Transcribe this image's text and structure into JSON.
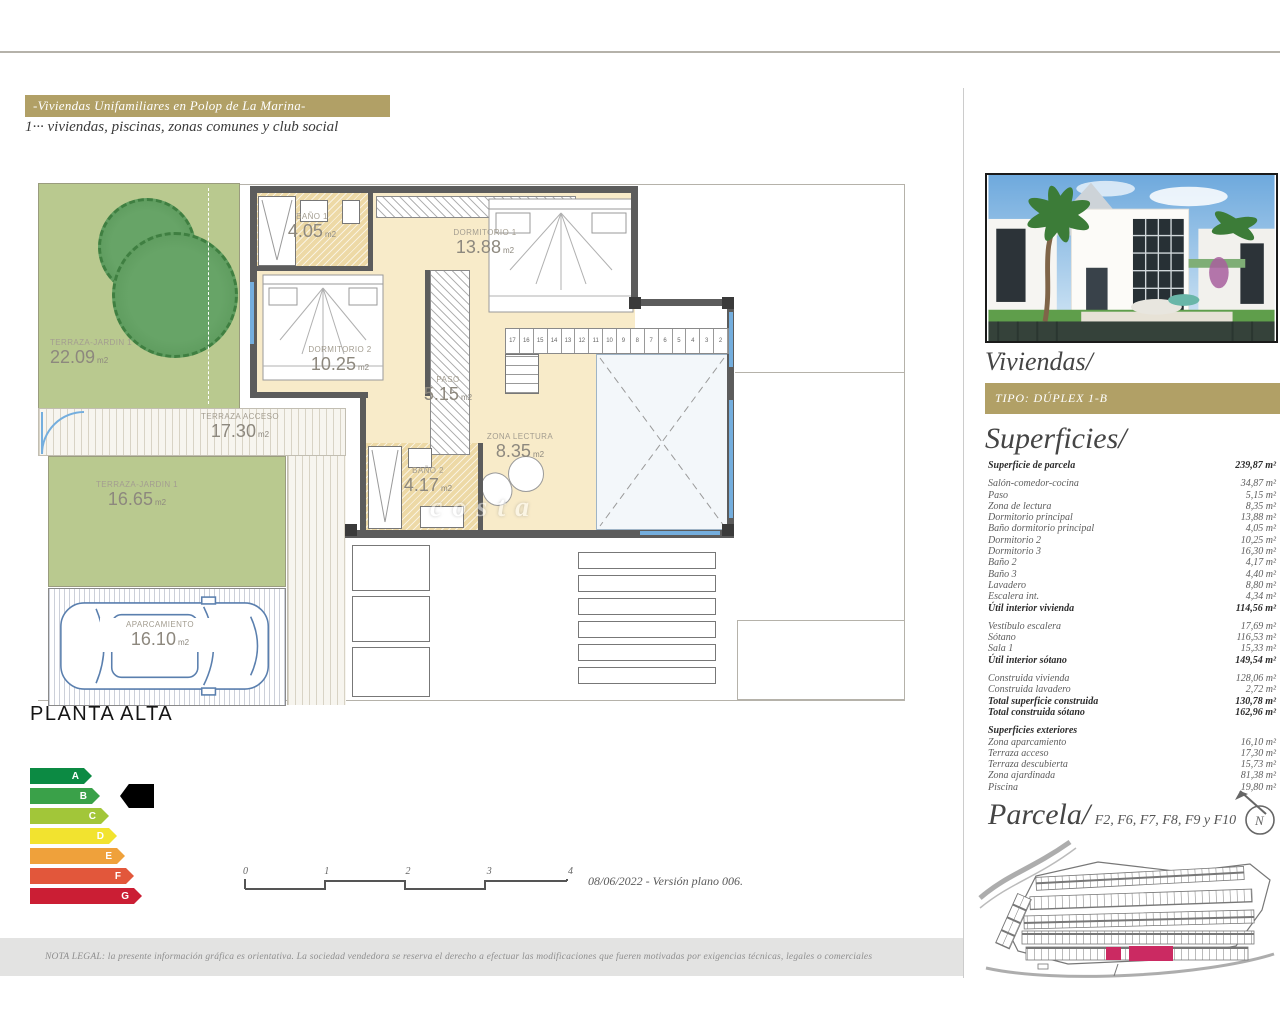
{
  "header": {
    "title": "-Viviendas Unifamiliares en Polop de La Marina-",
    "subtitle": "1··· viviendas, piscinas, zonas comunes y club social"
  },
  "plan": {
    "name": "PLANTA ALTA",
    "watermark": "costa",
    "rooms": {
      "bano1": {
        "label": "BAÑO 1",
        "area": "4.05",
        "unit": "m2"
      },
      "dorm1": {
        "label": "DORMITORIO 1",
        "area": "13.88",
        "unit": "m2"
      },
      "dorm2": {
        "label": "DORMITORIO 2",
        "area": "10.25",
        "unit": "m2"
      },
      "paso": {
        "label": "PASO",
        "area": "5.15",
        "unit": "m2"
      },
      "lectura": {
        "label": "ZONA LECTURA",
        "area": "8.35",
        "unit": "m2"
      },
      "bano2": {
        "label": "BAÑO 2",
        "area": "4.17",
        "unit": "m2"
      },
      "jardin1": {
        "label": "TERRAZA-JARDIN 1",
        "area": "22.09",
        "unit": "m2"
      },
      "acceso": {
        "label": "TERRAZA ACCESO",
        "area": "17.30",
        "unit": "m2"
      },
      "jardin2": {
        "label": "TERRAZA-JARDIN 1",
        "area": "16.65",
        "unit": "m2"
      },
      "aparcamiento": {
        "label": "APARCAMIENTO",
        "area": "16.10",
        "unit": "m2"
      }
    },
    "stairs": [
      "17",
      "16",
      "15",
      "14",
      "13",
      "12",
      "11",
      "10",
      "9",
      "8",
      "7",
      "6",
      "5",
      "4",
      "3",
      "2"
    ]
  },
  "energy": {
    "selected": "B",
    "grades": [
      {
        "letter": "A",
        "color": "#0c8a43",
        "width": 62
      },
      {
        "letter": "B",
        "color": "#3aa149",
        "width": 70
      },
      {
        "letter": "C",
        "color": "#a2c639",
        "width": 79
      },
      {
        "letter": "D",
        "color": "#f2e32f",
        "width": 87
      },
      {
        "letter": "E",
        "color": "#efa13b",
        "width": 95
      },
      {
        "letter": "F",
        "color": "#e2573b",
        "width": 104
      },
      {
        "letter": "G",
        "color": "#cb1e34",
        "width": 112
      }
    ]
  },
  "scalebar": {
    "ticks": [
      "0",
      "1",
      "2",
      "3",
      "4"
    ],
    "caption": "08/06/2022 - Versión plano 006."
  },
  "legal": {
    "text": "NOTA LEGAL: la presente información gráfica es orientativa. La sociedad vendedora se reserva el derecho a efectuar las modificaciones que fueren motivadas por exigencias técnicas, legales o comerciales"
  },
  "sidebar": {
    "viviendas_heading": "Viviendas/",
    "tipo_badge": "TIPO: DÚPLEX 1-B",
    "superficies": {
      "heading": "Superficies/",
      "groups": [
        {
          "rows": [
            {
              "l": "Superficie de parcela",
              "v": "239,87 m²",
              "b": true
            }
          ]
        },
        {
          "rows": [
            {
              "l": "Salón-comedor-cocina",
              "v": "34,87 m²"
            },
            {
              "l": "Paso",
              "v": "5,15 m²"
            },
            {
              "l": "Zona de lectura",
              "v": "8,35 m²"
            },
            {
              "l": "Dormitorio principal",
              "v": "13,88 m²"
            },
            {
              "l": "Baño dormitorio principal",
              "v": "4,05 m²"
            },
            {
              "l": "Dormitorio 2",
              "v": "10,25 m²"
            },
            {
              "l": "Dormitorio 3",
              "v": "16,30 m²"
            },
            {
              "l": "Baño 2",
              "v": "4,17 m²"
            },
            {
              "l": "Baño 3",
              "v": "4,40 m²"
            },
            {
              "l": "Lavadero",
              "v": "8,80 m²"
            },
            {
              "l": "Escalera int.",
              "v": "4,34 m²"
            },
            {
              "l": "Útil interior vivienda",
              "v": "114,56 m²",
              "b": true
            }
          ]
        },
        {
          "rows": [
            {
              "l": "Vestíbulo escalera",
              "v": "17,69 m²"
            },
            {
              "l": "Sótano",
              "v": "116,53 m²"
            },
            {
              "l": "Sala 1",
              "v": "15,33 m²"
            },
            {
              "l": "Útil interior sótano",
              "v": "149,54 m²",
              "b": true
            }
          ]
        },
        {
          "rows": [
            {
              "l": "Construida vivienda",
              "v": "128,06 m²"
            },
            {
              "l": "Construida lavadero",
              "v": "2,72 m²"
            },
            {
              "l": "Total superficie construida",
              "v": "130,78 m²",
              "b": true
            },
            {
              "l": "Total construida sótano",
              "v": "162,96 m²",
              "b": true
            }
          ]
        },
        {
          "rows": [
            {
              "l": "Superficies exteriores",
              "v": "",
              "b": true
            },
            {
              "l": "Zona aparcamiento",
              "v": "16,10 m²"
            },
            {
              "l": "Terraza acceso",
              "v": "17,30 m²"
            },
            {
              "l": "Terraza descubierta",
              "v": "15,73 m²"
            },
            {
              "l": "Zona ajardinada",
              "v": "81,38 m²"
            },
            {
              "l": "Piscina",
              "v": "19,80 m²"
            }
          ]
        }
      ]
    },
    "parcela_heading": "Parcela/",
    "parcela_plots": "F2, F6, F7, F8, F9 y F10",
    "compass_letter": "N"
  },
  "colors": {
    "gold": "#b1a066",
    "plot_highlight": "#cb2a62",
    "wall": "#5c5c5c",
    "window_blue": "#74aede"
  }
}
